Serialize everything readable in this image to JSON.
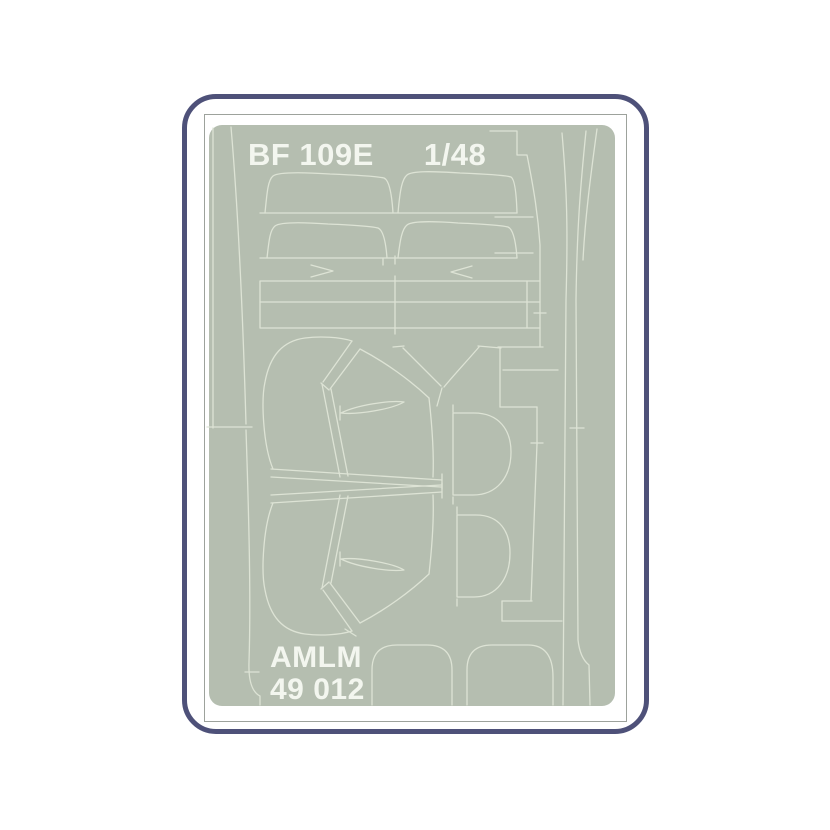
{
  "product_label": {
    "model": "BF 109E",
    "scale": "1/48",
    "brand": "AMLM",
    "product_code": "49 012"
  },
  "colors": {
    "page_background": "#ffffff",
    "frame_border": "#4e5179",
    "card_border": "#9da29c",
    "sheet": "#b5beb0",
    "cut_lines": "#dde3d5",
    "label_text": "#f3f6ef"
  }
}
